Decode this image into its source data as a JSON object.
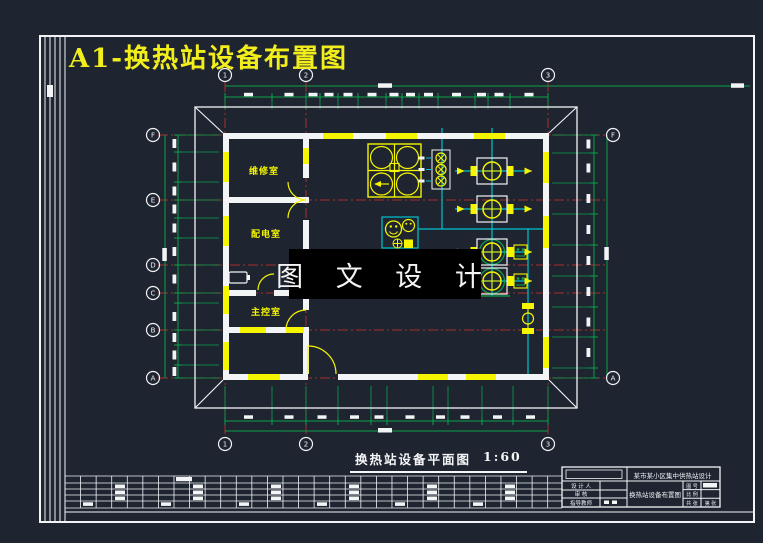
{
  "drawing": {
    "title": "A1-换热站设备布置图"
  },
  "watermark": {
    "text": "图 文 设 计"
  },
  "caption": {
    "text": "换热站设备平面图",
    "scale": "1:60"
  },
  "plan": {
    "rooms": [
      {
        "name": "维修室"
      },
      {
        "name": "配电室"
      },
      {
        "name": "主控室"
      }
    ]
  },
  "axes": {
    "top": [
      "1",
      "2",
      "3"
    ],
    "bottom": [
      "1",
      "2",
      "3"
    ],
    "left": [
      "F",
      "E",
      "D",
      "C",
      "B",
      "A"
    ],
    "right": [
      "F",
      "A"
    ]
  },
  "title_block": {
    "project": "某市某小区集中供热站设计",
    "drawing_name": "换热站设备布置图",
    "left_rows": [
      {
        "label": "设 计 人"
      },
      {
        "label": "审  核"
      },
      {
        "label": "指导教师"
      }
    ],
    "right_rows": [
      {
        "label": "图 号"
      },
      {
        "label": "比 例"
      },
      {
        "label": "共 张"
      },
      {
        "label": "第 张"
      }
    ]
  },
  "palette": {
    "background": "#1e2430",
    "line_white": "#f2f4f6",
    "cad_yellow": "#f5f500",
    "cad_green": "#0ca24a",
    "cad_red": "#a6302a",
    "cad_cyan": "#00c4cf",
    "watermark_bg": "#000000",
    "title_yellow": "#f2ee1b"
  }
}
